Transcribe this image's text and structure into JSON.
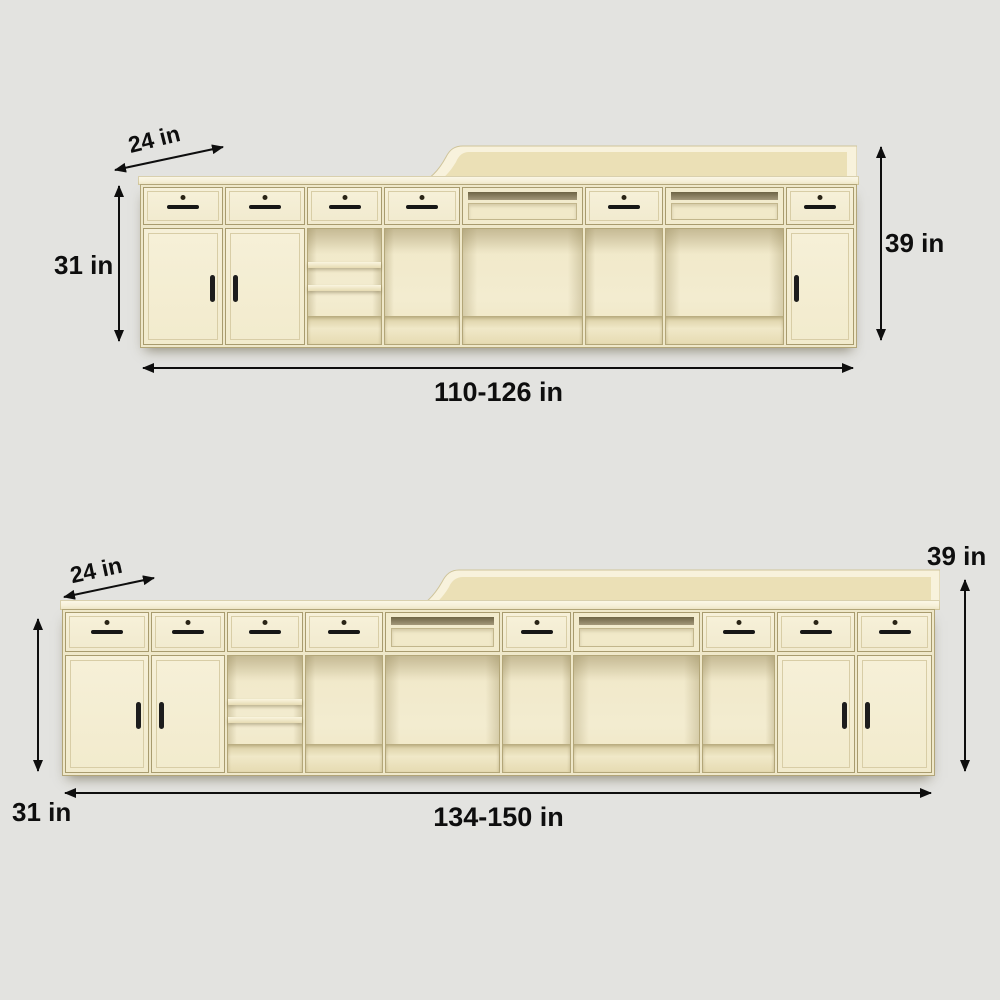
{
  "diagram": {
    "subject": "reception-desk-cabinet-dimensions",
    "units": [
      {
        "id": "top-unit",
        "depth": "24 in",
        "counter_height": "31 in",
        "total_height": "39 in",
        "width_range": "110-126 in"
      },
      {
        "id": "bottom-unit",
        "depth": "24 in",
        "counter_height": "31 in",
        "total_height": "39 in",
        "width_range": "134-150 in"
      }
    ]
  },
  "colors": {
    "background": "#e3e3e0",
    "cabinet_face": "#f4eed4",
    "cabinet_outline": "#a89b6e",
    "interior_shadow": "#d9cda1",
    "annotation_text": "#0e0e0e"
  }
}
